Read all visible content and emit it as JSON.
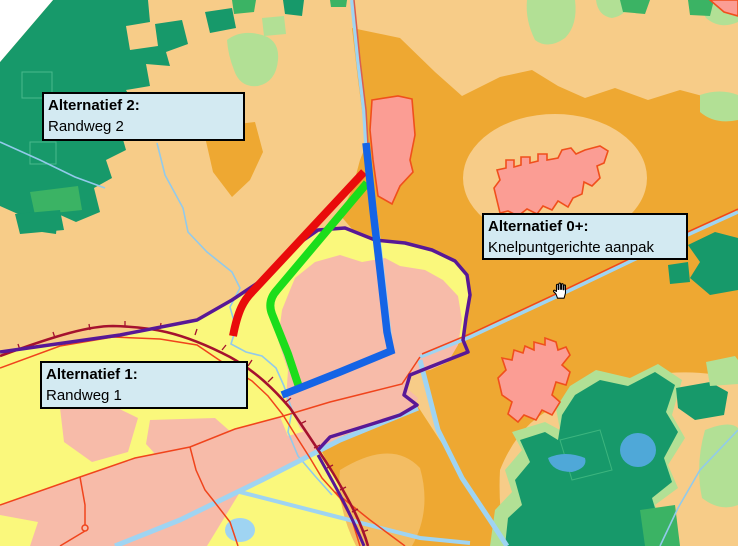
{
  "map": {
    "annotations": [
      {
        "id": "alt2",
        "title": "Alternatief 2:",
        "subtitle": "Randweg 2"
      },
      {
        "id": "alt0",
        "title": "Alternatief 0+:",
        "subtitle": "Knelpuntgerichte aanpak"
      },
      {
        "id": "alt1",
        "title": "Alternatief 1:",
        "subtitle": "Randweg 1"
      }
    ],
    "routes": [
      {
        "id": "route-red",
        "color": "#e90b0b"
      },
      {
        "id": "route-green",
        "color": "#1bdd1b"
      },
      {
        "id": "route-blue",
        "color": "#1464e6"
      }
    ],
    "cursor": "open-hand-pan",
    "colors": {
      "mapBase": "#f7cc88",
      "forestDark": "#17996a",
      "forestMid": "#3bb364",
      "forestLight": "#b2e095",
      "orangeDark": "#eea832",
      "orangeMid": "#f3bd63",
      "yellow": "#faf87c",
      "pinkArea": "#f7bba9",
      "settlementFill": "#fb9d94",
      "settlementOutline": "#f04f1c",
      "stream": "#92caeb",
      "channel": "#9fd4f2",
      "lake": "#4fa8d8",
      "purpleBoundary": "#581896",
      "ringRoad": "#a5122e",
      "roadThin": "#f0441c",
      "canalRoad": "#d95f4f",
      "routeRed": "#e90b0b",
      "routeGreen": "#1bdd1b",
      "routeBlue": "#1464e6",
      "labelFill": "#d3eaf2",
      "labelBorder": "#000000",
      "mapEdge": "#ffffff"
    }
  }
}
